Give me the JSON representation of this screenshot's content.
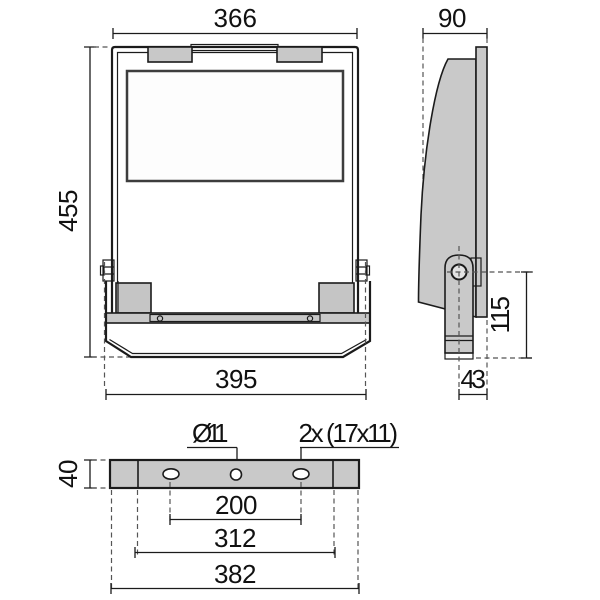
{
  "front_view": {
    "width_top": "366",
    "height": "455",
    "width_bottom": "395"
  },
  "side_view": {
    "depth": "90",
    "bracket_height": "115",
    "bracket_offset": "43"
  },
  "bottom_view": {
    "center_hole": "Ø11",
    "slot_note": "2x (17x11)",
    "bracket_thickness": "40",
    "hole_spacing": "200",
    "inner_width": "312",
    "overall_width": "382"
  },
  "colors": {
    "line": "#1b1b1b",
    "gray_fill": "#c8c8c8",
    "dark_gray": "#8d8d8d"
  }
}
